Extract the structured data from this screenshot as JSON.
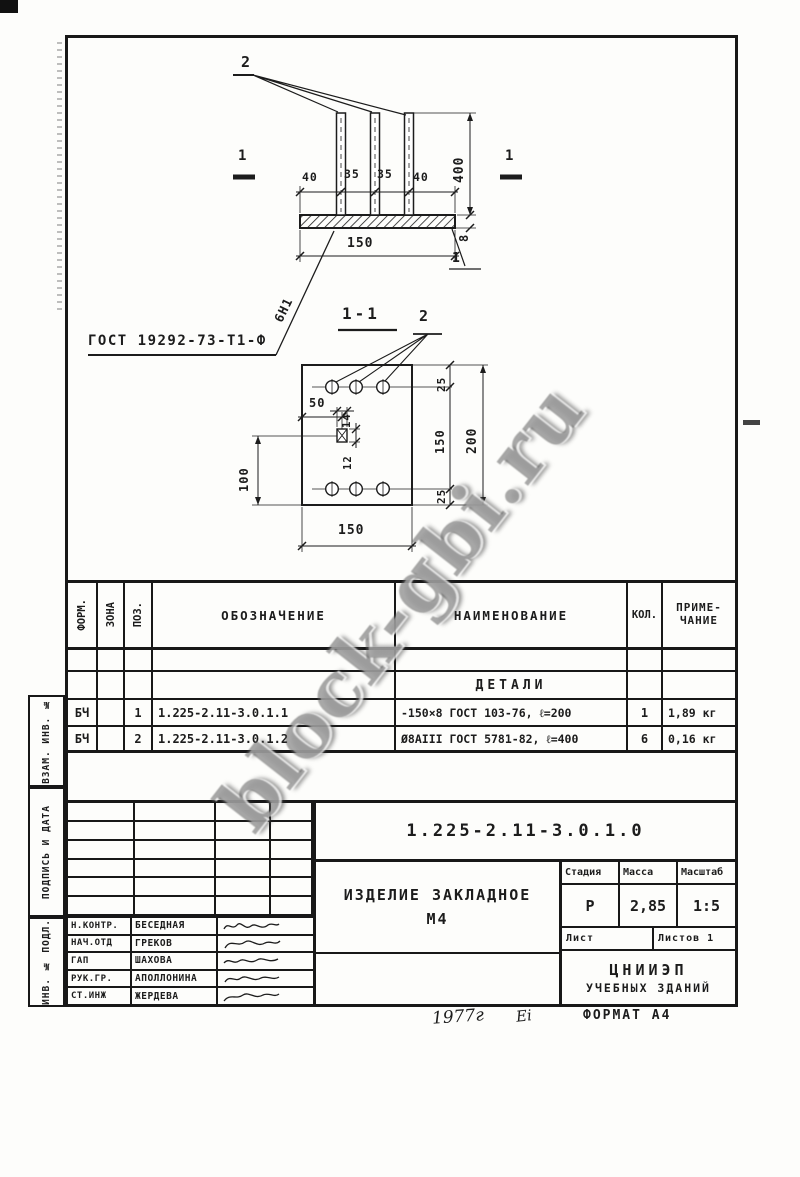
{
  "watermark": {
    "text": "block-gbi.ru"
  },
  "front_view": {
    "callout_top": "2",
    "section_label_left": "1",
    "section_label_right": "1",
    "dims_top": [
      "40",
      "35",
      "35",
      "40"
    ],
    "dim_anchor_length": "400",
    "dim_plate_thickness": "8",
    "dim_plate_width": "150",
    "weld_mark": "6Н1",
    "weld_gost_label": "ГОСТ 19292-73-Т1-Ф",
    "callout_plate": "1"
  },
  "section_view": {
    "title": "1-1",
    "callout": "2",
    "dim_edge_top": "25",
    "dim_between_anchors": "150",
    "dim_edge_bottom": "25",
    "dim_height": "200",
    "dim_hole_offset_x": "50",
    "dim_hole_width": "14",
    "dim_hole_height": "12",
    "dim_hole_offset_y": "100",
    "dim_width": "150"
  },
  "parts_table": {
    "headers": {
      "form": "ФОРМ.",
      "zone": "ЗОНА",
      "pos": "ПОЗ.",
      "designation": "ОБОЗНАЧЕНИЕ",
      "name": "НАИМЕНОВАНИЕ",
      "qty": "КОЛ.",
      "note_line1": "ПРИМЕ-",
      "note_line2": "ЧАНИЕ"
    },
    "group_title": "ДЕТАЛИ",
    "rows": [
      {
        "form": "БЧ",
        "zone": "",
        "pos": "1",
        "designation": "1.225-2.11-3.0.1.1",
        "name": "-150×8 ГОСТ 103-76, ℓ=200",
        "qty": "1",
        "note": "1,89 кг"
      },
      {
        "form": "БЧ",
        "zone": "",
        "pos": "2",
        "designation": "1.225-2.11-3.0.1.2",
        "name": "Ø8АIII ГОСТ 5781-82, ℓ=400",
        "qty": "6",
        "note": "0,16 кг"
      }
    ]
  },
  "title_block": {
    "document_number": "1.225-2.11-3.0.1.0",
    "product_title_line1": "ИЗДЕЛИЕ ЗАКЛАДНОЕ",
    "product_title_line2": "М4",
    "stage_label": "Стадия",
    "stage_value": "Р",
    "mass_label": "Масса",
    "mass_value": "2,85",
    "scale_label": "Масштаб",
    "scale_value": "1:5",
    "sheet_label": "Лист",
    "sheets_label": "Листов",
    "sheets_value": "1",
    "organization_line1": "ЦНИИЭП",
    "organization_line2": "УЧЕБНЫХ ЗДАНИЙ",
    "signatures": [
      {
        "role": "Н.КОНТР.",
        "name": "БЕСЕДНАЯ"
      },
      {
        "role": "НАЧ.ОТД",
        "name": "ГРЕКОВ"
      },
      {
        "role": "ГАП",
        "name": "ШАХОВА"
      },
      {
        "role": "РУК.ГР.",
        "name": "АПОЛЛОНИНА"
      },
      {
        "role": "СТ.ИНЖ",
        "name": "ЖЕРДЕВА"
      }
    ]
  },
  "margin_labels": {
    "vzam_inv": "ВЗАМ. ИНВ. №",
    "podpis_data": "ПОДПИСЬ И ДАТА",
    "inv_podl": "ИНВ. № ПОДЛ."
  },
  "footer": {
    "year": "1977г",
    "mark": "Ei",
    "format": "ФОРМАТ А4"
  },
  "colors": {
    "ink": "#1c1c1c",
    "paper": "#fdfdfb",
    "watermark_gray": "#585858"
  }
}
